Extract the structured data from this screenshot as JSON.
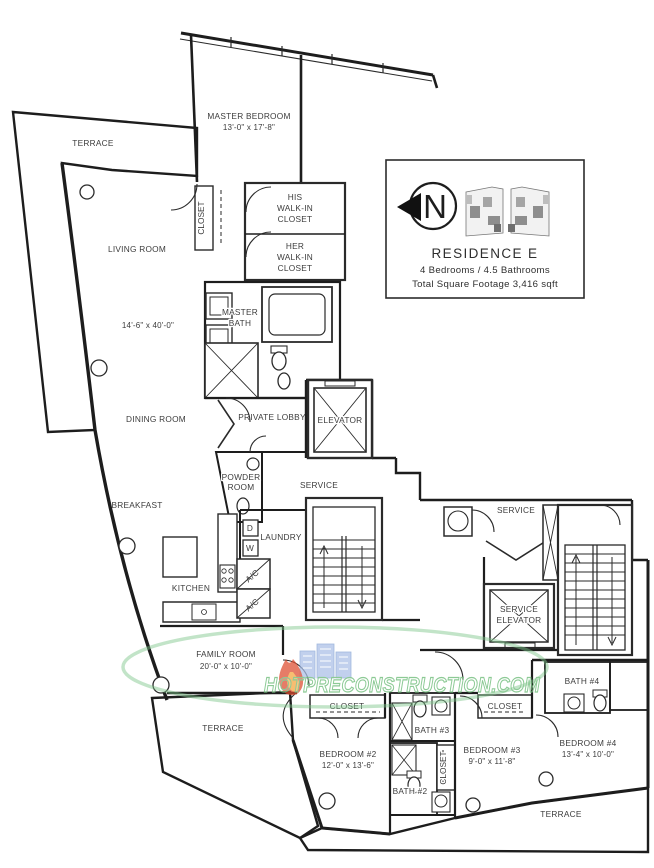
{
  "meta": {
    "sheet": "floor-plan",
    "width_px": 654,
    "height_px": 868
  },
  "legend": {
    "north_letter": "N",
    "residence_title": "RESIDENCE E",
    "bedrooms_bathrooms": "4 Bedrooms / 4.5 Bathrooms",
    "square_footage": "Total Square Footage  3,416 sqft"
  },
  "watermark": {
    "text": "HOTPRECONSTRUCTION.COM"
  },
  "rooms": {
    "terrace_top_left": {
      "label": "TERRACE"
    },
    "master_bedroom": {
      "name": "MASTER BEDROOM",
      "dims": "13'-0\" x 17'-8\""
    },
    "closet_gallery": {
      "label": "CLOSET"
    },
    "his_closet": {
      "line1": "HIS",
      "line2": "WALK-IN",
      "line3": "CLOSET"
    },
    "her_closet": {
      "line1": "HER",
      "line2": "WALK-IN",
      "line3": "CLOSET"
    },
    "living_room": {
      "name": "LIVING ROOM",
      "dims": "14'-6\" x 40'-0\""
    },
    "master_bath": {
      "line1": "MASTER",
      "line2": "BATH"
    },
    "dining_room": {
      "name": "DINING ROOM"
    },
    "private_lobby": {
      "name": "PRIVATE LOBBY"
    },
    "elevator": {
      "label": "ELEVATOR"
    },
    "powder_room": {
      "line1": "POWDER",
      "line2": "ROOM"
    },
    "service_hall": {
      "label": "SERVICE"
    },
    "breakfast": {
      "label": "BREAKFAST"
    },
    "laundry": {
      "label": "LAUNDRY",
      "dryer": "D",
      "washer": "W"
    },
    "ac_upper": {
      "label": "A/C"
    },
    "ac_lower": {
      "label": "A/C"
    },
    "kitchen": {
      "label": "KITCHEN"
    },
    "service_area": {
      "label": "SERVICE"
    },
    "service_elevator": {
      "line1": "SERVICE",
      "line2": "ELEVATOR"
    },
    "family_room": {
      "name": "FAMILY ROOM",
      "dims": "20'-0\" x 10'-0\""
    },
    "terrace_bottom_left": {
      "label": "TERRACE"
    },
    "closet_bedroom2": {
      "label": "CLOSET"
    },
    "bedroom2": {
      "name": "BEDROOM #2",
      "dims": "12'-0\" x 13'-6\""
    },
    "bath3": {
      "label": "BATH #3"
    },
    "closet_hall": {
      "label": "CLOSET"
    },
    "bath2": {
      "label": "BATH #2"
    },
    "closet_bedroom3": {
      "label": "CLOSET"
    },
    "bedroom3": {
      "name": "BEDROOM #3",
      "dims": "9'-0\" x 11'-8\""
    },
    "bath4": {
      "label": "BATH #4"
    },
    "bedroom4": {
      "name": "BEDROOM #4",
      "dims": "13'-4\" x 10'-0\""
    },
    "terrace_bottom_right": {
      "label": "TERRACE"
    }
  },
  "colors": {
    "wall": "#1d1d1d",
    "label": "#3c3c3c",
    "watermark_green": "#79c183",
    "watermark_blue": "#aabfe7",
    "watermark_flame": "#dd4a2e"
  }
}
